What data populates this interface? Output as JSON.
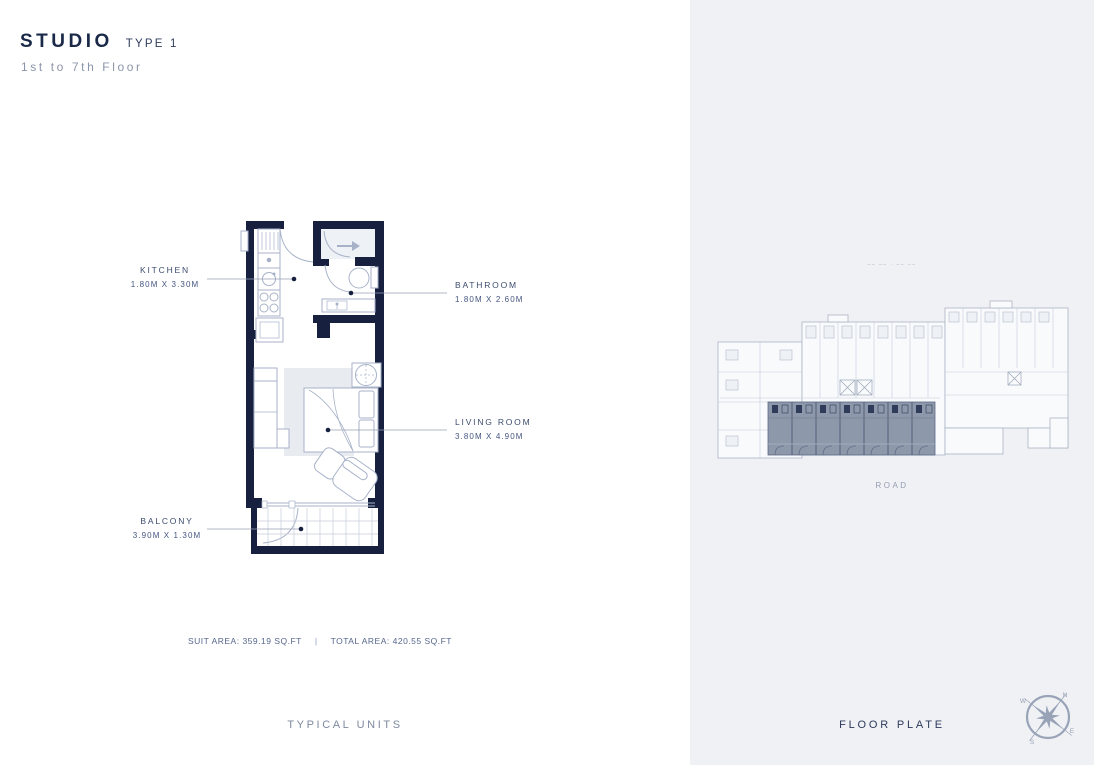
{
  "header": {
    "title": "STUDIO",
    "type_label": "TYPE 1",
    "floor_range": "1st to 7th Floor"
  },
  "unit_plan": {
    "rooms": [
      {
        "name": "KITCHEN",
        "dims": "1.80M X 3.30M"
      },
      {
        "name": "BATHROOM",
        "dims": "1.80M X 2.60M"
      },
      {
        "name": "LIVING ROOM",
        "dims": "3.80M X 4.90M"
      },
      {
        "name": "BALCONY",
        "dims": "3.90M X 1.30M"
      }
    ],
    "suit_area": "SUIT AREA: 359.19 SQ.FT",
    "divider": "|",
    "total_area": "TOTAL AREA: 420.55 SQ.FT",
    "section_label": "TYPICAL UNITS"
  },
  "floor_plate": {
    "plot_marks": "–– ––  ·  –– ––",
    "road_label": "ROAD",
    "section_label": "FLOOR PLATE",
    "compass": {
      "north": "N",
      "east": "E",
      "south": "S",
      "west": "W"
    }
  },
  "colors": {
    "wall": "#17213f",
    "accent_text": "#2c3a5c",
    "muted_text": "#8b95a9",
    "panel_bg": "#f0f1f4",
    "plan_line": "#a7b2c8",
    "highlight": "#8d98ab"
  }
}
